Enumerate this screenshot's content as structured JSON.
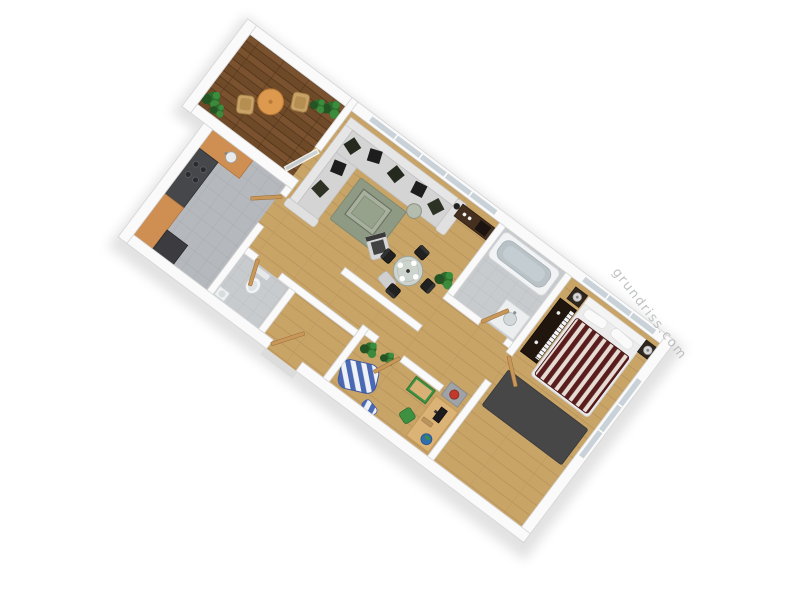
{
  "meta": {
    "type": "3d-floorplan-render",
    "background": "#ffffff"
  },
  "watermark": {
    "text": "grundriss.com",
    "color": "#b4b7b9",
    "rotation_deg": 52
  },
  "palette": {
    "wall": "#fafafa",
    "wall_edge": "#d6d6d6",
    "wood_floor": "#c9a467",
    "balcony_deck": "#6f4a28",
    "kitchen_tile": "#b5b9bd",
    "bath_tile": "#c7cbce",
    "sofa_gray": "#d4d4d4",
    "pillow_dark": "#23281e",
    "rug_living_green": "#8f9a84",
    "rug_bedroom_gray": "#474747",
    "duvet_maroon": "#5a1d1d",
    "duvet_cream": "#e7dcd4",
    "bed_frame_white": "#ececec",
    "dark_wood": "#45301f",
    "door_wood": "#c8975a",
    "counter_orange": "#cf8f52",
    "balcony_table_orange": "#dd9a4f",
    "cabinet_green": "#3f9142",
    "beanbag_blue": "#4a69b4",
    "plant_green": "#2e6b2e",
    "window_glass": "#c9d2d8",
    "lamp_red": "#c0392b"
  },
  "rooms": [
    {
      "name": "balcony",
      "floor": "dark wood deck",
      "furniture": [
        "round orange table",
        "wicker chair",
        "wicker chair",
        "potted plants",
        "potted plants",
        "open glass door"
      ]
    },
    {
      "name": "living-room",
      "floor": "light wood",
      "furniture": [
        "corner sofa with dark cushions",
        "green rug",
        "glass coffee table",
        "armchair",
        "ottoman",
        "round side table",
        "floor lamp",
        "dark wood sideboard",
        "potted plant",
        "round glass dining table with 4 place settings",
        "4 black dining chairs"
      ]
    },
    {
      "name": "kitchen",
      "floor": "gray tile",
      "furniture": [
        "counter with sink",
        "dark appliance block with burners",
        "counter",
        "tall dark cabinet"
      ]
    },
    {
      "name": "bathroom",
      "floor": "light gray tile",
      "furniture": [
        "bathtub",
        "washbasin counter"
      ]
    },
    {
      "name": "wc",
      "floor": "light gray tile",
      "furniture": [
        "toilet",
        "corner basin"
      ]
    },
    {
      "name": "hallway",
      "floor": "light wood",
      "furniture": [
        "open wooden doors",
        "entry door",
        "gray cabinet with red lamp",
        "potted plants"
      ]
    },
    {
      "name": "bedroom",
      "floor": "light wood",
      "furniture": [
        "double bed with maroon striped duvet",
        "white headboard with pillows",
        "nightstand with lamp",
        "nightstand with lamp",
        "dark piano / media unit",
        "large dark gray rug"
      ]
    },
    {
      "name": "office",
      "floor": "light wood",
      "furniture": [
        "birch desk",
        "monitor",
        "keyboard",
        "globe",
        "green desk chair",
        "green drawer cabinet",
        "blue striped beanbag",
        "striped cushion",
        "potted plants"
      ]
    }
  ]
}
